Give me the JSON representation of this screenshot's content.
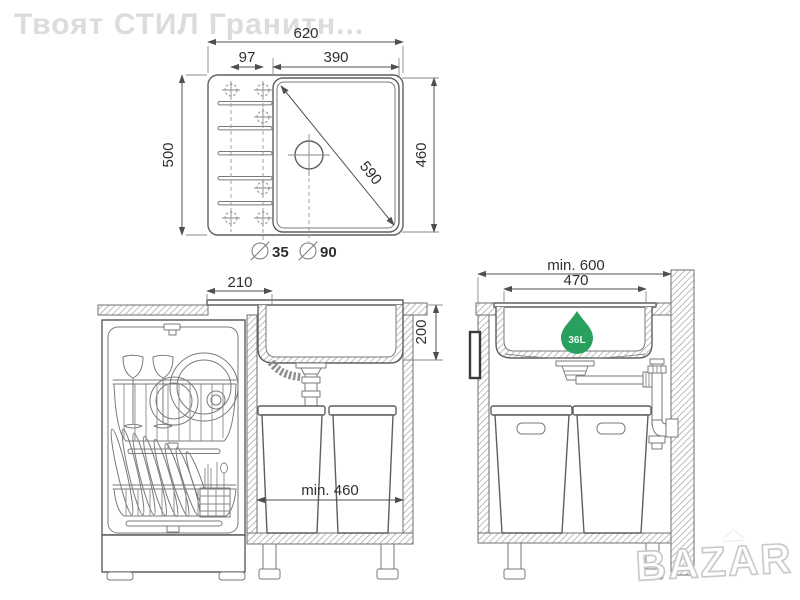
{
  "watermark": {
    "brand": "Твоят СТИЛ Гранитн...",
    "logo": "BAZAR"
  },
  "colors": {
    "accent_green": "#2aa05f",
    "line_gray": "#5f5f5f",
    "dimension_text": "#2f2f2f",
    "watermark_gray": "#dcdcdc"
  },
  "top_view": {
    "overall_width": "620",
    "tap_hole_spacing": "97",
    "bowl_width": "390",
    "overall_depth": "500",
    "bowl_depth": "460",
    "bowl_diagonal": "590",
    "tap_hole_diameter": "35",
    "drain_hole_diameter": "90"
  },
  "side_view": {
    "drainboard_width": "210",
    "bowl_height": "200",
    "min_cabinet_width": "min. 460"
  },
  "front_view": {
    "min_cabinet_width": "min. 600",
    "bowl_width": "470",
    "bowl_capacity": "36L"
  }
}
